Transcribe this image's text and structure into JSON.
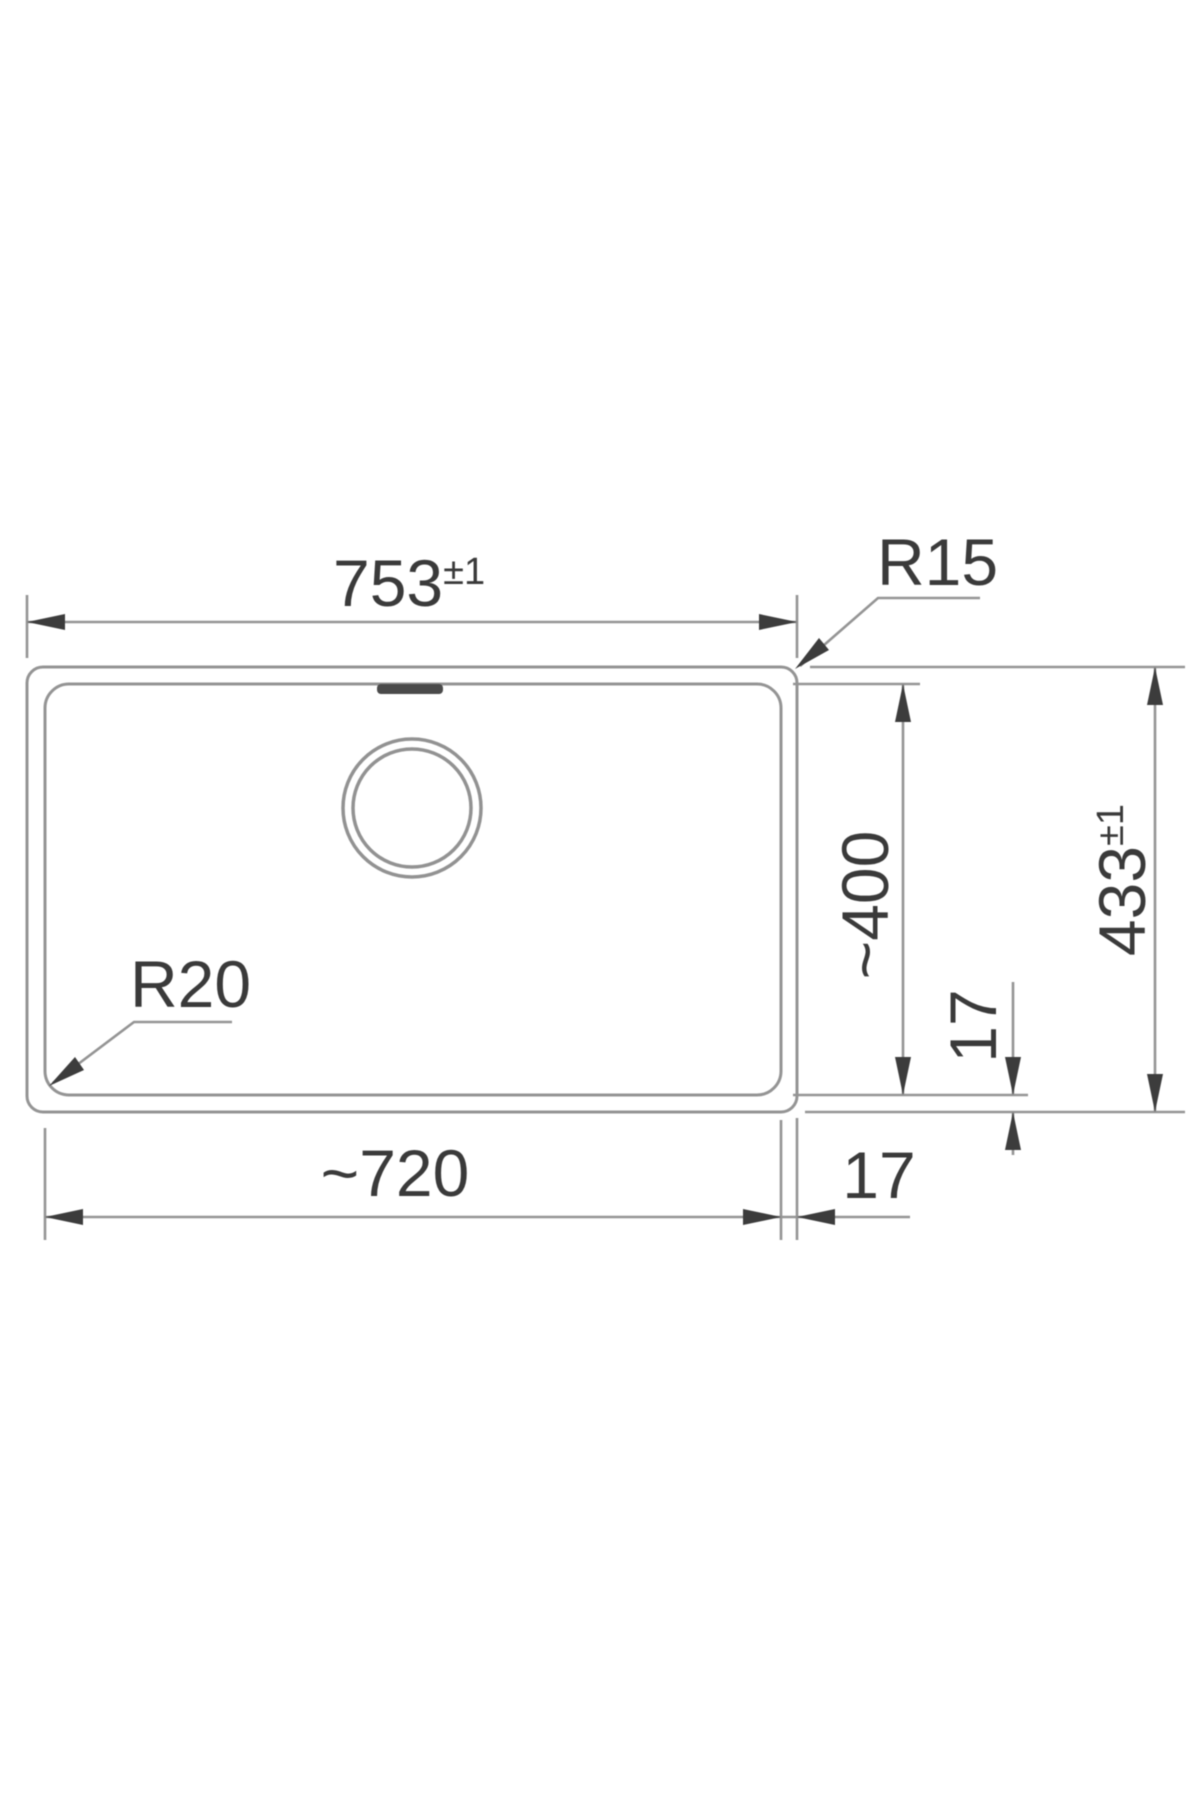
{
  "page": {
    "background": "#ffffff"
  },
  "drawing": {
    "line_color": "#949494",
    "ink_color": "#3a3a3a",
    "slot_color": "#4a4a4a",
    "dimensions": {
      "overall_width": {
        "value": "753",
        "tolerance": "±1"
      },
      "overall_depth": {
        "value": "433",
        "tolerance": "±1"
      },
      "bowl_width": "~720",
      "bowl_depth": "~400",
      "rim_width_right": "17",
      "rim_width_bottom": "17",
      "corner_radius_outer": "R15",
      "corner_radius_bowl": "R20"
    }
  }
}
